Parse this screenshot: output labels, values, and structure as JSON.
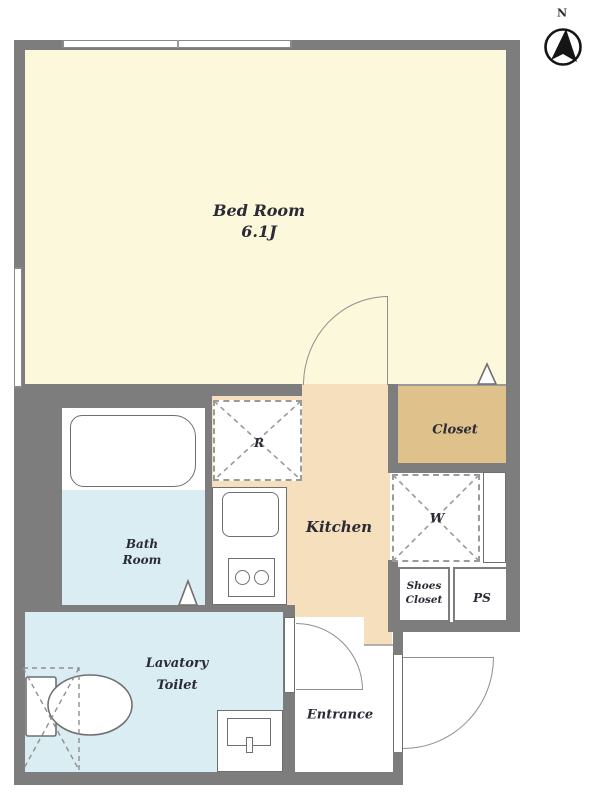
{
  "compass": {
    "label": "N"
  },
  "rooms": {
    "bedroom": {
      "name": "Bed Room",
      "size": "6.1J"
    },
    "kitchen": {
      "label": "Kitchen"
    },
    "closet": {
      "label": "Closet"
    },
    "bathroom": {
      "line1": "Bath",
      "line2": "Room"
    },
    "lavatory": {
      "line1": "Lavatory",
      "line2": "Toilet"
    },
    "entrance": {
      "label": "Entrance"
    },
    "shoes_closet": {
      "line1": "Shoes",
      "line2": "Closet"
    },
    "pipe_space": {
      "label": "PS"
    },
    "refrigerator_space": {
      "label": "R"
    },
    "washer_space": {
      "label": "W"
    }
  },
  "fixtures": [
    "bathtub",
    "toilet",
    "washbasin",
    "kitchen-sink",
    "gas-stove",
    "refrigerator-space",
    "washer-space",
    "north-compass",
    "window",
    "hinged-door"
  ],
  "colors": {
    "bedroom": "#fbf8dc",
    "kitchen": "#f6dfbd",
    "closet": "#dfc18c",
    "water": "#d9edf2",
    "wall": "#7d7d7d",
    "line": "#9a9a9a",
    "stroke": "#6f6f6f",
    "text": "#2b2b35"
  }
}
